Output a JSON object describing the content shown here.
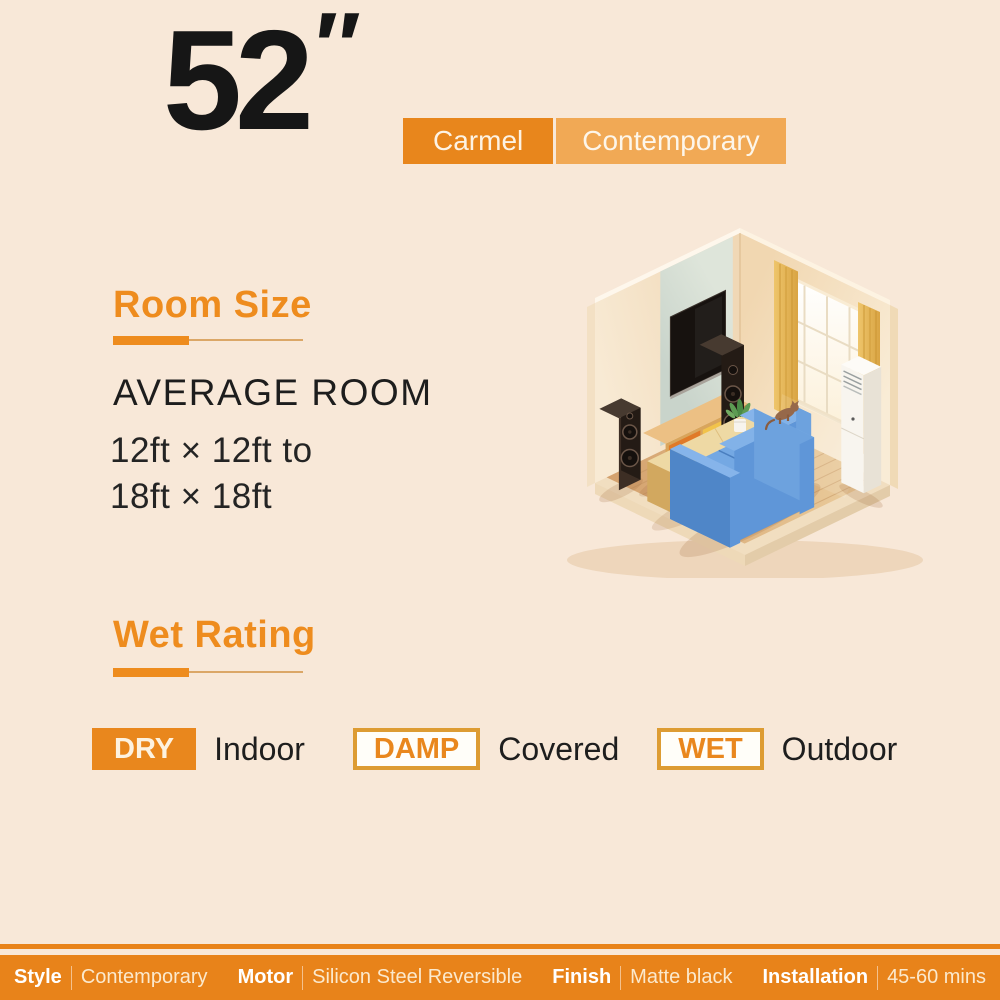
{
  "page": {
    "background_color": "#f8e8d8"
  },
  "header": {
    "size_value": "52",
    "size_unit": "″",
    "series_badge": "Carmel",
    "style_badge": "Contemporary"
  },
  "room_size": {
    "title": "Room Size",
    "subtitle": "AVERAGE ROOM",
    "range_line1": "12ft × 12ft to",
    "range_line2": "18ft × 18ft"
  },
  "illustration": {
    "name": "isometric-living-room",
    "elements": [
      "tv",
      "tv-panel",
      "speakers",
      "tv-stand",
      "window",
      "curtains",
      "air-conditioner",
      "sofa",
      "coffee-table",
      "plant",
      "cat",
      "wood-floor"
    ]
  },
  "wet_rating": {
    "title": "Wet Rating",
    "items": [
      {
        "badge": "DRY",
        "label": "Indoor",
        "badge_style": "solid"
      },
      {
        "badge": "DAMP",
        "label": "Covered",
        "badge_style": "outline"
      },
      {
        "badge": "WET",
        "label": "Outdoor",
        "badge_style": "outline"
      }
    ]
  },
  "footer": {
    "specs": [
      {
        "label": "Style",
        "value": "Contemporary"
      },
      {
        "label": "Motor",
        "value": "Silicon Steel Reversible"
      },
      {
        "label": "Finish",
        "value": "Matte black"
      },
      {
        "label": "Installation",
        "value": "45-60 mins"
      }
    ]
  },
  "colors": {
    "accent_orange": "#e8861c",
    "accent_orange_light": "#f1a955",
    "heading_orange": "#ee8c1e",
    "badge_border": "#dd9c33",
    "footer_bg": "#e8831a",
    "background": "#f8e8d8",
    "text_dark": "#1d1d1d"
  }
}
